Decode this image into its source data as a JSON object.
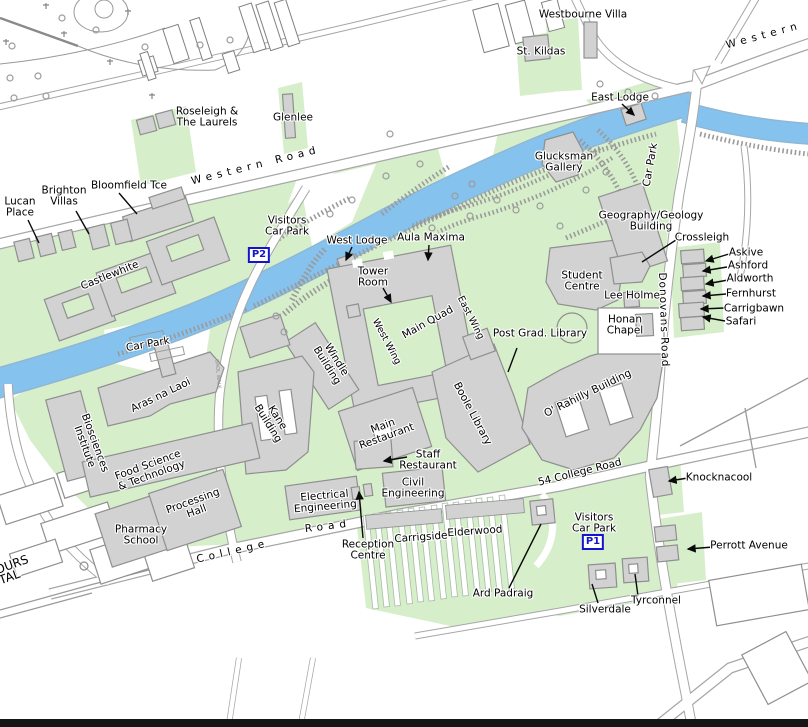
{
  "map": {
    "colors": {
      "campus_green": "#d6efca",
      "river_blue": "#86c2ee",
      "building_gray": "#d2d2d2",
      "outline_gray": "#8f8f8f",
      "road_casing": "#a6a6a6",
      "label_black": "#000000",
      "parking_blue": "#1414cc"
    },
    "parking_badges": [
      {
        "id": "p2",
        "label": "P2",
        "x": 259,
        "y": 255
      },
      {
        "id": "p1",
        "label": "P1",
        "x": 593,
        "y": 542
      }
    ],
    "labels": [
      {
        "id": "westbourne-villa",
        "lines": [
          "Westbourne Villa"
        ],
        "x": 583,
        "y": 15
      },
      {
        "id": "st-kildas",
        "lines": [
          "St. Kildas"
        ],
        "x": 541,
        "y": 52
      },
      {
        "id": "western-road-east",
        "lines": [
          "Western"
        ],
        "x": 764,
        "y": 36,
        "rot": -15,
        "ls": 5
      },
      {
        "id": "east-lodge",
        "lines": [
          "East Lodge"
        ],
        "x": 620,
        "y": 98
      },
      {
        "id": "glucksman-gallery",
        "lines": [
          "Glucksman",
          "Gallery"
        ],
        "x": 564,
        "y": 163
      },
      {
        "id": "car-park-east",
        "lines": [
          "Car Park"
        ],
        "x": 651,
        "y": 165,
        "rot": -80
      },
      {
        "id": "roseleigh",
        "lines": [
          "Roseleigh &",
          "The Laurels"
        ],
        "x": 207,
        "y": 118
      },
      {
        "id": "glenlee",
        "lines": [
          "Glenlee"
        ],
        "x": 293,
        "y": 118
      },
      {
        "id": "western-road",
        "lines": [
          "Western  Road"
        ],
        "x": 256,
        "y": 166,
        "rot": -14,
        "ls": 5
      },
      {
        "id": "lucan-place",
        "lines": [
          "Lucan",
          "Place"
        ],
        "x": 20,
        "y": 208
      },
      {
        "id": "brighton-villas",
        "lines": [
          "Brighton",
          "Villas"
        ],
        "x": 64,
        "y": 197
      },
      {
        "id": "bloomfield-tce",
        "lines": [
          "Bloomfield Tce"
        ],
        "x": 129,
        "y": 186
      },
      {
        "id": "visitors-car-park-p2",
        "lines": [
          "Visitors",
          "Car Park"
        ],
        "x": 287,
        "y": 227
      },
      {
        "id": "west-lodge",
        "lines": [
          "West Lodge"
        ],
        "x": 357,
        "y": 241
      },
      {
        "id": "aula-maxima",
        "lines": [
          "Aula Maxima"
        ],
        "x": 431,
        "y": 238
      },
      {
        "id": "tower-room",
        "lines": [
          "Tower",
          "Room"
        ],
        "x": 373,
        "y": 278
      },
      {
        "id": "castlewhite",
        "lines": [
          "Castlewhite"
        ],
        "x": 110,
        "y": 276,
        "rot": -22
      },
      {
        "id": "car-park-west",
        "lines": [
          "Car Park"
        ],
        "x": 148,
        "y": 345,
        "rot": -10
      },
      {
        "id": "main-quad",
        "lines": [
          "Main Quad"
        ],
        "x": 428,
        "y": 323,
        "rot": -29
      },
      {
        "id": "west-wing",
        "lines": [
          "West Wing"
        ],
        "x": 386,
        "y": 342,
        "rot": 62,
        "fs": 9.5
      },
      {
        "id": "east-wing",
        "lines": [
          "East Wing"
        ],
        "x": 470,
        "y": 318,
        "rot": 63,
        "fs": 9.5
      },
      {
        "id": "windle-building",
        "lines": [
          "Windle",
          "Building"
        ],
        "x": 331,
        "y": 363,
        "rot": 58
      },
      {
        "id": "student-centre",
        "lines": [
          "Student",
          "Centre"
        ],
        "x": 582,
        "y": 282
      },
      {
        "id": "geography-geology",
        "lines": [
          "Geography/Geology",
          "Building"
        ],
        "x": 651,
        "y": 222
      },
      {
        "id": "crossleigh",
        "lines": [
          "Crossleigh"
        ],
        "x": 702,
        "y": 238
      },
      {
        "id": "askive",
        "lines": [
          "Askive"
        ],
        "x": 746,
        "y": 253
      },
      {
        "id": "ashford",
        "lines": [
          "Ashford"
        ],
        "x": 748,
        "y": 266
      },
      {
        "id": "aldworth",
        "lines": [
          "Aldworth"
        ],
        "x": 750,
        "y": 279
      },
      {
        "id": "fernhurst",
        "lines": [
          "Fernhurst"
        ],
        "x": 751,
        "y": 294
      },
      {
        "id": "carrigbawn",
        "lines": [
          "Carrigbawn"
        ],
        "x": 754,
        "y": 309
      },
      {
        "id": "safari",
        "lines": [
          "Safari"
        ],
        "x": 741,
        "y": 322
      },
      {
        "id": "donovans-road",
        "lines": [
          "Donovans Road"
        ],
        "x": 663,
        "y": 320,
        "rot": 88,
        "ls": 1
      },
      {
        "id": "lee-holme",
        "lines": [
          "Lee Holme"
        ],
        "x": 632,
        "y": 296
      },
      {
        "id": "honan-chapel",
        "lines": [
          "Honan",
          "Chapel"
        ],
        "x": 625,
        "y": 326
      },
      {
        "id": "post-grad-library",
        "lines": [
          "Post Grad. Library"
        ],
        "x": 540,
        "y": 334
      },
      {
        "id": "boole-library",
        "lines": [
          "Boole Library"
        ],
        "x": 472,
        "y": 414,
        "rot": 62
      },
      {
        "id": "o-rahilly-building",
        "lines": [
          "O' Rahilly Building"
        ],
        "x": 588,
        "y": 394,
        "rot": -26
      },
      {
        "id": "main-restaurant",
        "lines": [
          "Main",
          "Restaurant"
        ],
        "x": 385,
        "y": 432,
        "rot": -20
      },
      {
        "id": "staff-restaurant",
        "lines": [
          "Staff",
          "Restaurant"
        ],
        "x": 428,
        "y": 461
      },
      {
        "id": "civil-engineering",
        "lines": [
          "Civil",
          "Engineering"
        ],
        "x": 413,
        "y": 489
      },
      {
        "id": "electrical-engineering",
        "lines": [
          "Electrical",
          "Engineering"
        ],
        "x": 325,
        "y": 502,
        "rot": -5
      },
      {
        "id": "kane-building",
        "lines": [
          "Kane",
          "Building"
        ],
        "x": 272,
        "y": 421,
        "rot": 58
      },
      {
        "id": "aras-na-laoi",
        "lines": [
          "Aras na Laoi"
        ],
        "x": 161,
        "y": 396,
        "rot": -26
      },
      {
        "id": "biosciences-institute",
        "lines": [
          "Biosciences",
          "Institute"
        ],
        "x": 89,
        "y": 445,
        "rot": 70
      },
      {
        "id": "food-science",
        "lines": [
          "Food Science",
          "& Technology"
        ],
        "x": 150,
        "y": 471,
        "rot": -20
      },
      {
        "id": "processing-hall",
        "lines": [
          "Processing",
          "Hall"
        ],
        "x": 195,
        "y": 507,
        "rot": -20
      },
      {
        "id": "pharmacy-school",
        "lines": [
          "Pharmacy",
          "School"
        ],
        "x": 141,
        "y": 536
      },
      {
        "id": "college-road-west",
        "lines": [
          "College"
        ],
        "x": 233,
        "y": 552,
        "rot": -13,
        "ls": 5
      },
      {
        "id": "college-road-mid",
        "lines": [
          "Road"
        ],
        "x": 328,
        "y": 527,
        "rot": -7,
        "ls": 5
      },
      {
        "id": "reception-centre",
        "lines": [
          "Reception",
          "Centre"
        ],
        "x": 368,
        "y": 551
      },
      {
        "id": "carrigside",
        "lines": [
          "Carrigside"
        ],
        "x": 421,
        "y": 538,
        "rot": -4
      },
      {
        "id": "elderwood",
        "lines": [
          "Elderwood"
        ],
        "x": 475,
        "y": 532,
        "rot": -4
      },
      {
        "id": "fifty-four-college-road",
        "lines": [
          "54 College Road"
        ],
        "x": 580,
        "y": 473,
        "rot": -14
      },
      {
        "id": "knocknacool",
        "lines": [
          "Knocknacool"
        ],
        "x": 719,
        "y": 478
      },
      {
        "id": "visitors-car-park-p1",
        "lines": [
          "Visitors",
          "Car Park"
        ],
        "x": 594,
        "y": 524
      },
      {
        "id": "perrott-avenue",
        "lines": [
          "Perrott Avenue"
        ],
        "x": 749,
        "y": 546
      },
      {
        "id": "ard-padraig",
        "lines": [
          "Ard Padraig"
        ],
        "x": 503,
        "y": 594
      },
      {
        "id": "silverdale",
        "lines": [
          "Silverdale"
        ],
        "x": 605,
        "y": 610
      },
      {
        "id": "tyrconnel",
        "lines": [
          "Tyrconnel"
        ],
        "x": 656,
        "y": 601
      },
      {
        "id": "hospital-ours",
        "lines": [
          "OURS"
        ],
        "x": 12,
        "y": 565,
        "rot": -20,
        "fs": 12
      },
      {
        "id": "hospital-ital",
        "lines": [
          "ITAL"
        ],
        "x": 8,
        "y": 578,
        "rot": -20,
        "fs": 12
      },
      {
        "id": "gaol-walk",
        "lines": [
          "GAOL WALK"
        ],
        "x": 217,
        "y": 374,
        "rot": 85,
        "fs": 5,
        "color": "#8a8a8a"
      }
    ]
  }
}
